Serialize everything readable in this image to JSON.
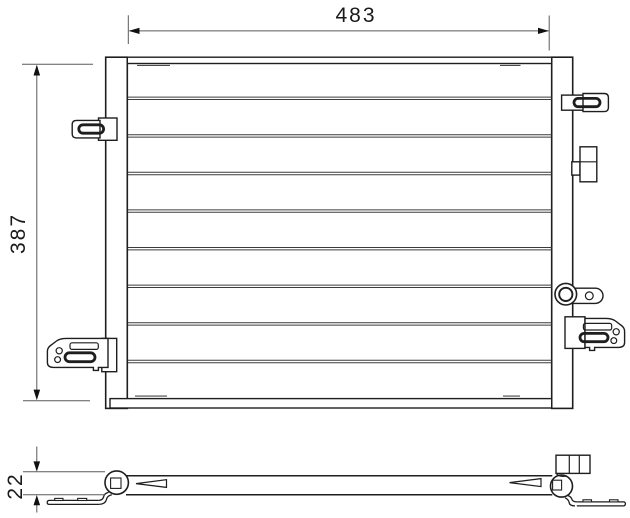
{
  "drawing": {
    "front_view": {
      "width_label": "483",
      "height_label": "387"
    },
    "side_view": {
      "thickness_label": "22"
    }
  },
  "colors": {
    "background": "#ffffff",
    "line": "#1e1e1e",
    "tube": "#3c3c3c",
    "seam": "#4a4a4a",
    "dim": "#5a5a5a",
    "arrow": "#111111",
    "text": "#1a1a1a"
  }
}
